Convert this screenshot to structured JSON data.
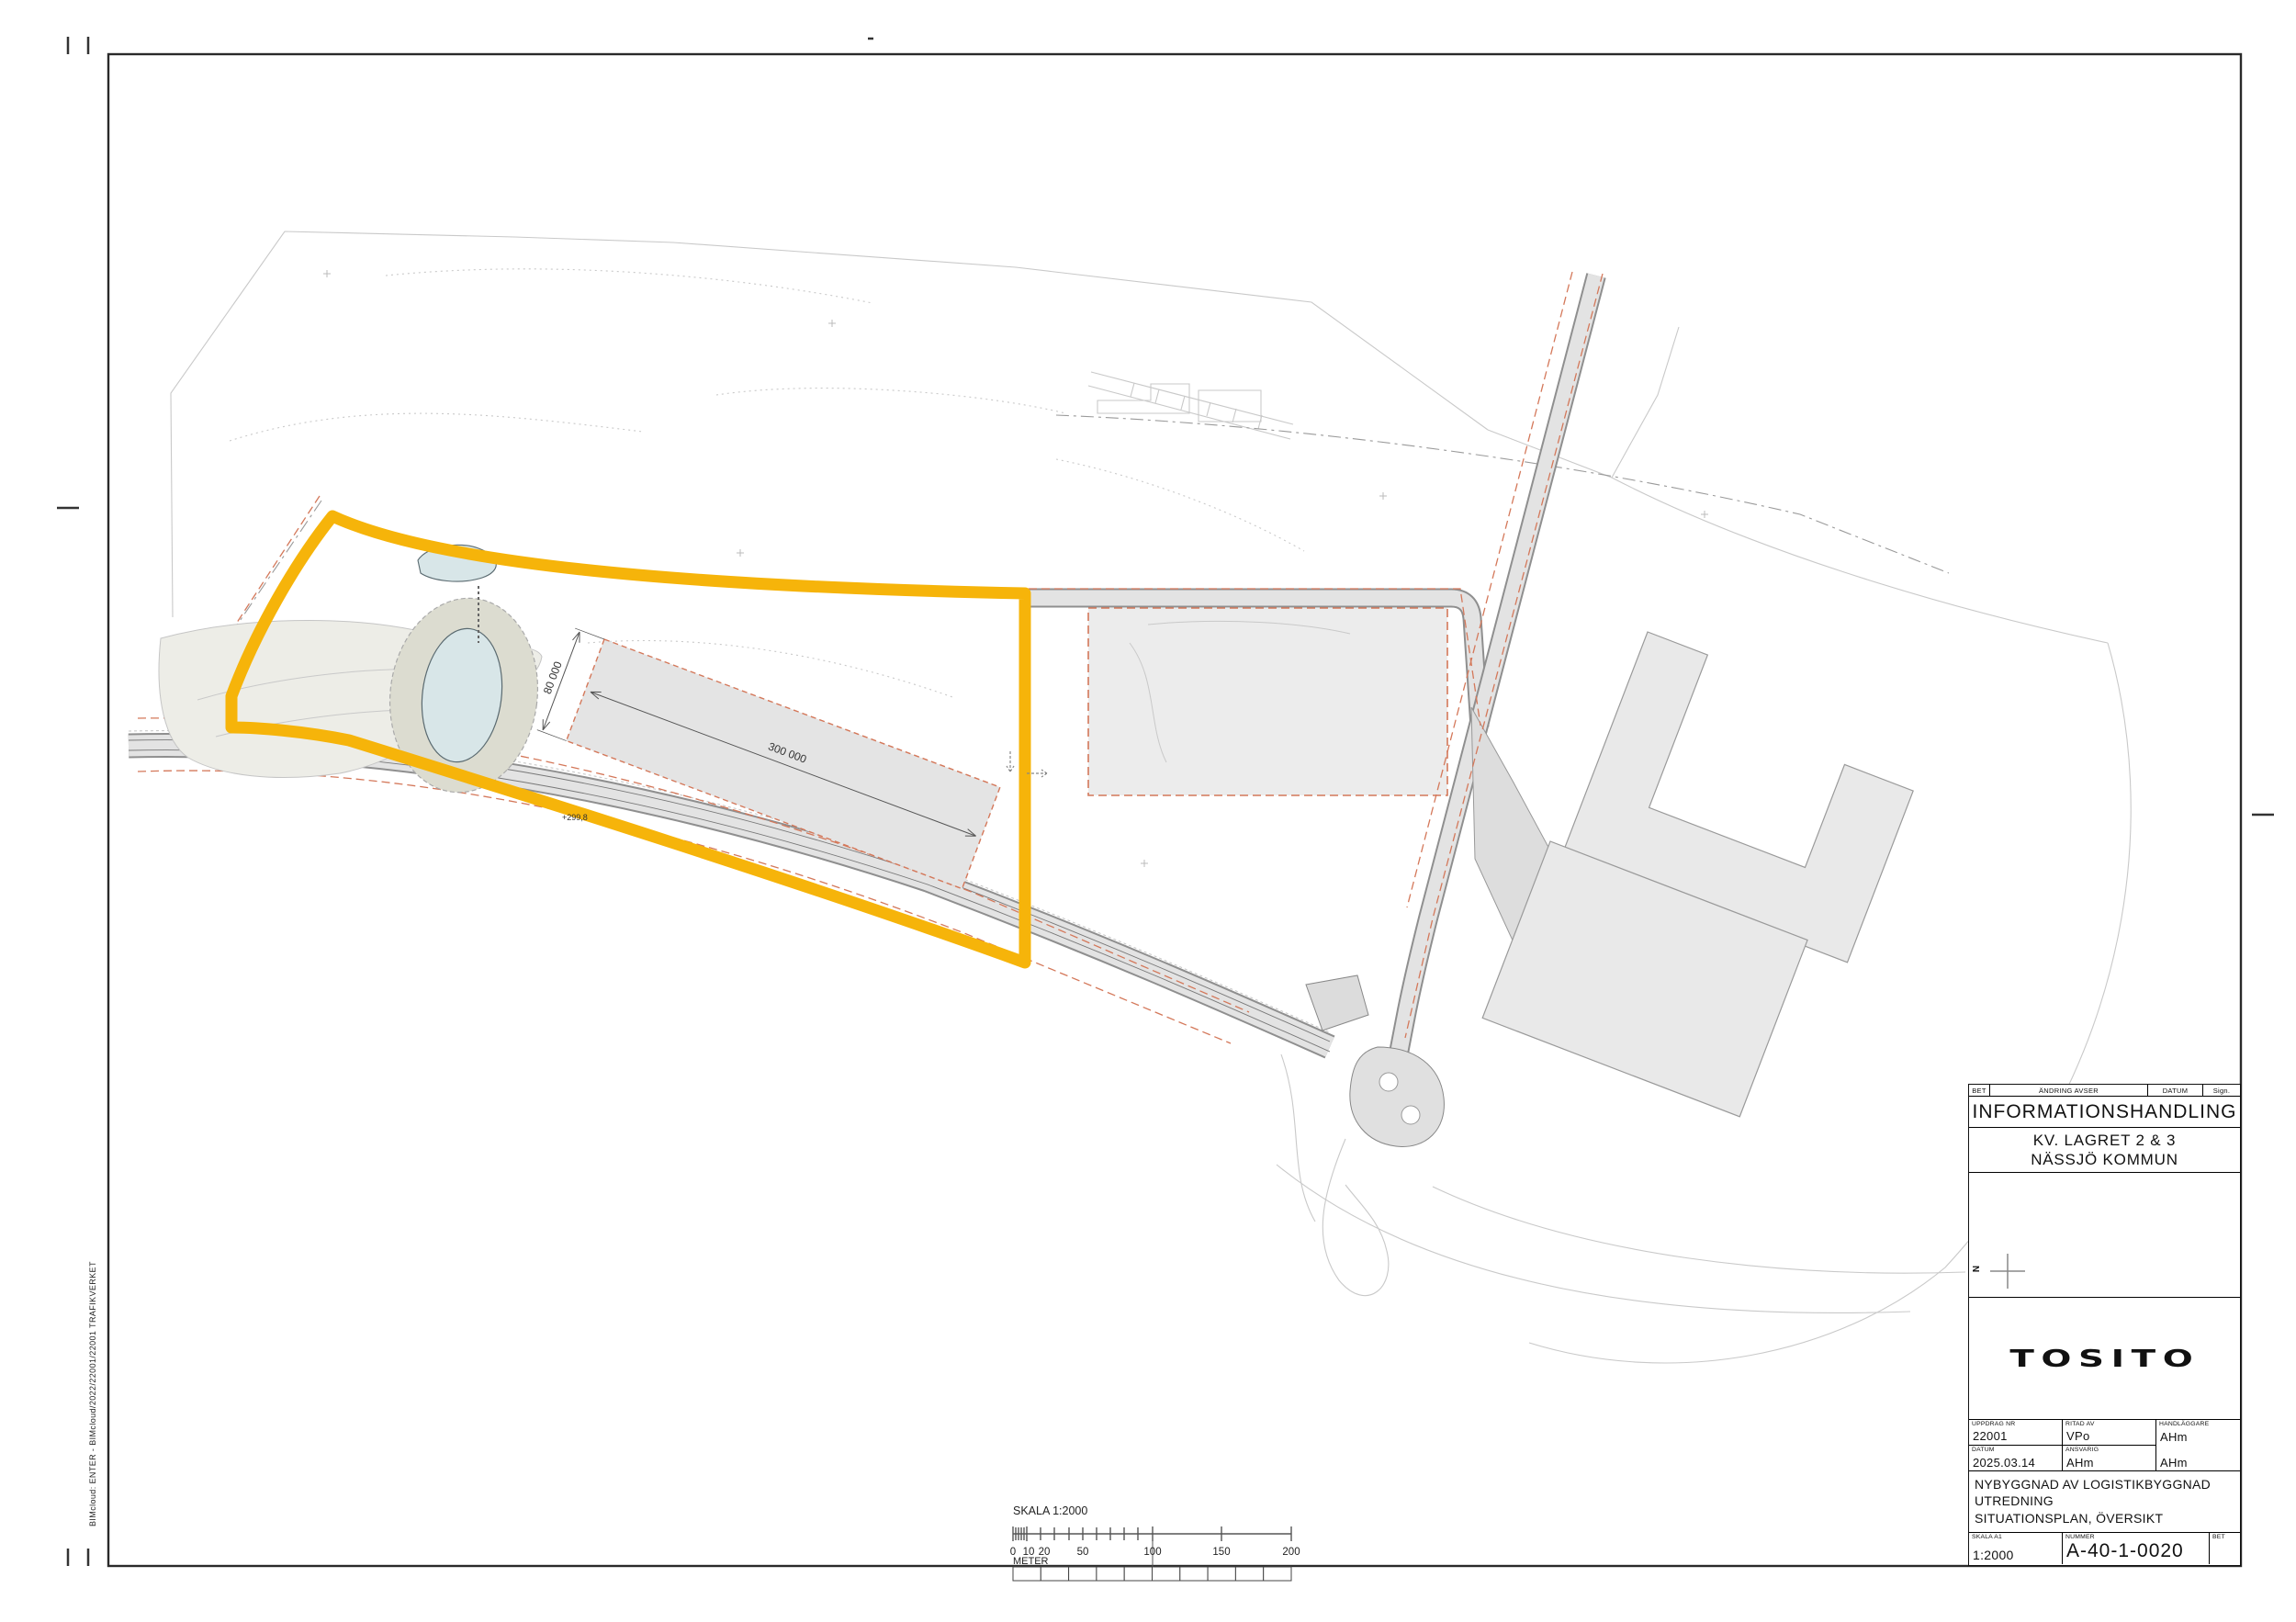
{
  "side_note": {
    "text": "BIMcloud: ENTER - BIMcloud/2022/22001/22001 TRAFIKVERKET"
  },
  "plan": {
    "dim_length": "300 000",
    "dim_width": "80 000",
    "elevation": "+299,8"
  },
  "scale_bar": {
    "title": "SKALA 1:2000",
    "unit": "METER",
    "ticks": [
      "0",
      "10",
      "20",
      "50",
      "100",
      "150",
      "200"
    ]
  },
  "tb": {
    "header": {
      "bet": "BET",
      "change": "ÄNDRING AVSER",
      "datum": "DATUM",
      "sign": "Sign."
    },
    "doc_type": "INFORMATIONSHANDLING",
    "project1": "KV. LAGRET 2 & 3",
    "project2": "NÄSSJÖ KOMMUN",
    "north": "N",
    "logo": "TOSITO",
    "f": {
      "uppdrag_label": "UPPDRAG NR",
      "uppdrag": "22001",
      "ritad_label": "RITAD AV",
      "ritad": "VPo",
      "handl_label": "HANDLÄGGARE",
      "handl": "AHm",
      "datum_label": "DATUM",
      "datum": "2025.03.14",
      "ansvarig_label": "ANSVARIG",
      "ansvarig": "AHm",
      "handl2": "AHm"
    },
    "desc": [
      "NYBYGGNAD AV LOGISTIKBYGGNAD",
      "UTREDNING",
      "SITUATIONSPLAN, ÖVERSIKT"
    ],
    "skala_label": "SKALA A1",
    "skala": "1:2000",
    "nummer_label": "NUMMER",
    "nummer": "A-40-1-0020",
    "bet_label": "BET",
    "bet": ""
  },
  "colors": {
    "boundary_yellow": "#F6B40A",
    "property_dash_salmon": "#D4785A",
    "road_fill": "#E3E3E3",
    "building_fill": "#E9E9E9",
    "pond_fill": "#D8E6E8",
    "terrain_line": "#C9C9C9"
  }
}
